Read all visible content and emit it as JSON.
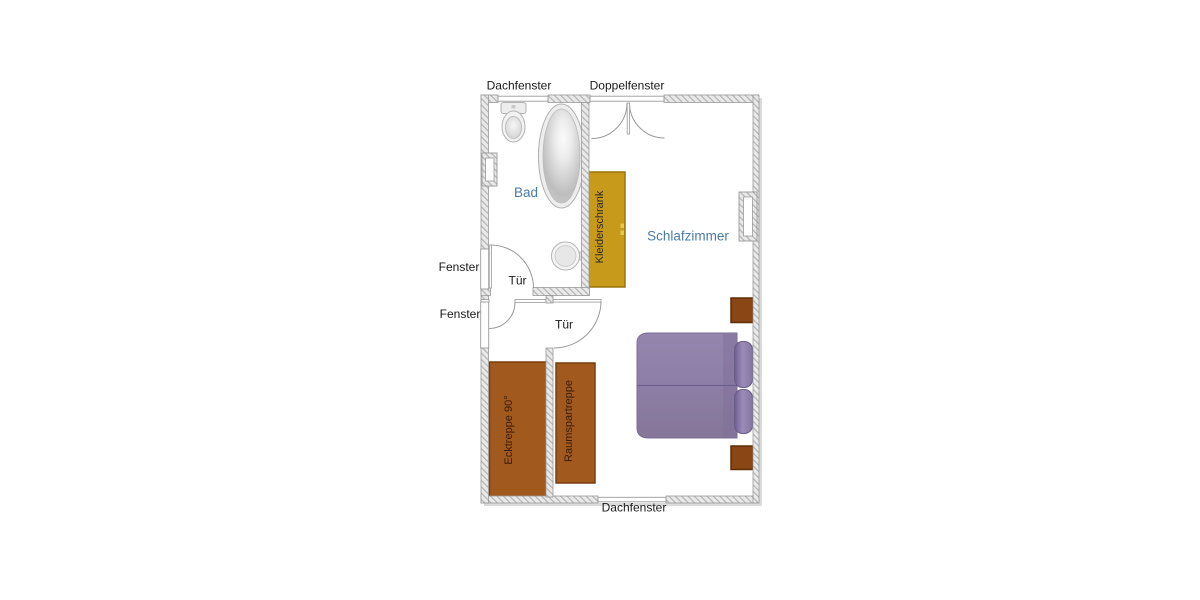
{
  "title": "Dachgeschoss Grundriss",
  "labels": {
    "dachfenster_top": "Dachfenster",
    "doppelfenster": "Doppelfenster",
    "fenster_upper": "Fenster",
    "fenster_lower": "Fenster",
    "tuer_bad": "Tür",
    "tuer_hall": "Tür",
    "dachfenster_bottom": "Dachfenster",
    "bad": "Bad",
    "schlafzimmer": "Schlafzimmer",
    "kleiderschrank": "Kleiderschrank",
    "ecktreppe": "Ecktreppe 90°",
    "raumspartreppe": "Raumspartreppe"
  },
  "colors": {
    "label": "#1a1a1a",
    "room_label": "#4a7ba6",
    "wardrobe": "#c79a1b",
    "wardrobe_handle": "#e8c74e",
    "stairs": "#a2591e",
    "stair_label": "#3a1d06",
    "nightstand": "#8a4715",
    "blanket_seam": "#6f6190"
  },
  "rooms": [
    {
      "name": "Bad",
      "features": [
        "Dachfenster",
        "Fenster",
        "Tür",
        "WC",
        "Badewanne",
        "Waschbecken"
      ]
    },
    {
      "name": "Schlafzimmer",
      "features": [
        "Doppelfenster",
        "Dachfenster",
        "Fenster",
        "Tür",
        "Kleiderschrank",
        "Bett",
        "Raumspartreppe"
      ]
    },
    {
      "name": "Treppenraum",
      "features": [
        "Fenster",
        "Ecktreppe 90°"
      ]
    }
  ]
}
